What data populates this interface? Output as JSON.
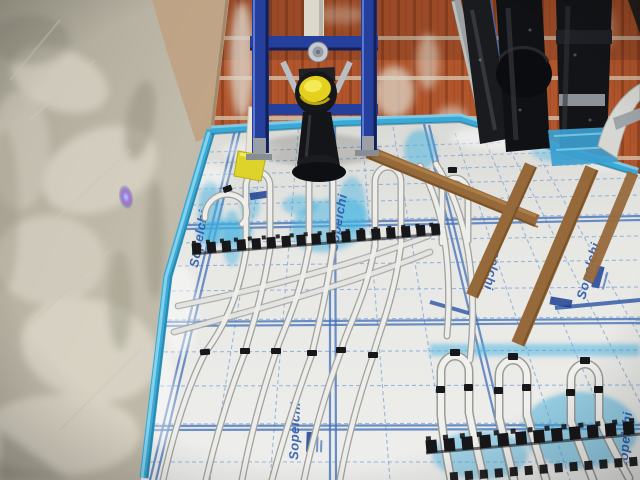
{
  "meta": {
    "description": "Construction photograph of a bathroom: blue in-wall toilet carrier frame with a yellow protective cap mounted on a terracotta hollow-block wall, black soil pipes to the right, a freshly plastered grey wall on the left, and underfloor-heating pipes clipped in serpentine loops onto white insulation panels printed with a blue grid, edged with a bright blue perimeter strip and crossed by wooden battens."
  },
  "floor": {
    "panel_brand_text": "Sopelchi"
  },
  "palette": {
    "frame_blue": "#24409c",
    "cap_yellow": "#e3d11d",
    "brick_terracotta": "#b0552c",
    "edge_strip_blue": "#3aa9d6",
    "panel_grid_blue": "#3f6fb8",
    "panel_white": "#e9e9e7",
    "pipe_white": "#ededeb",
    "clip_black": "#17171a",
    "wood_batten": "#96693b",
    "plaster_grey": "#b5b1a2"
  }
}
